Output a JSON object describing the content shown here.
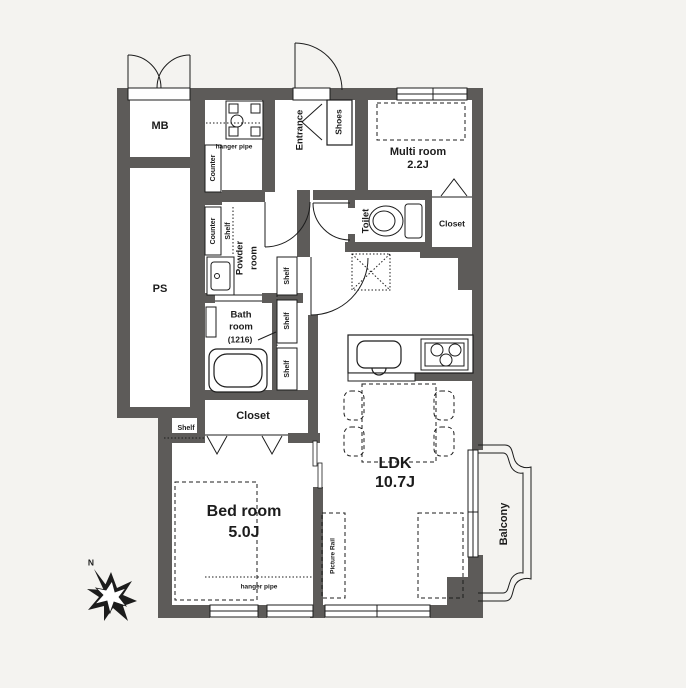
{
  "colors": {
    "background": "#f4f3f0",
    "wall": "#5d5b59",
    "floor": "#ffffff",
    "line": "#1c1c1c"
  },
  "rooms": {
    "mb": "MB",
    "ps": "PS",
    "entrance": "Entrance",
    "shoes": "Shoes",
    "multi_room": {
      "name": "Multi room",
      "size": "2.2J"
    },
    "toilet": "Toilet",
    "closet": "Closet",
    "powder_room": {
      "line1": "Powder",
      "line2": "room"
    },
    "bath_room": {
      "line1": "Bath",
      "line2": "room",
      "size": "(1216)"
    },
    "bed_room": {
      "name": "Bed room",
      "size": "5.0J"
    },
    "ldk": {
      "name": "LDK",
      "size": "10.7J"
    },
    "balcony": "Balcony"
  },
  "fixtures": {
    "counter": "Counter",
    "shelf": "Shelf",
    "hanger_pipe": "hanger pipe",
    "picture_rail": "Picture Rail"
  },
  "compass": {
    "north": "N"
  }
}
